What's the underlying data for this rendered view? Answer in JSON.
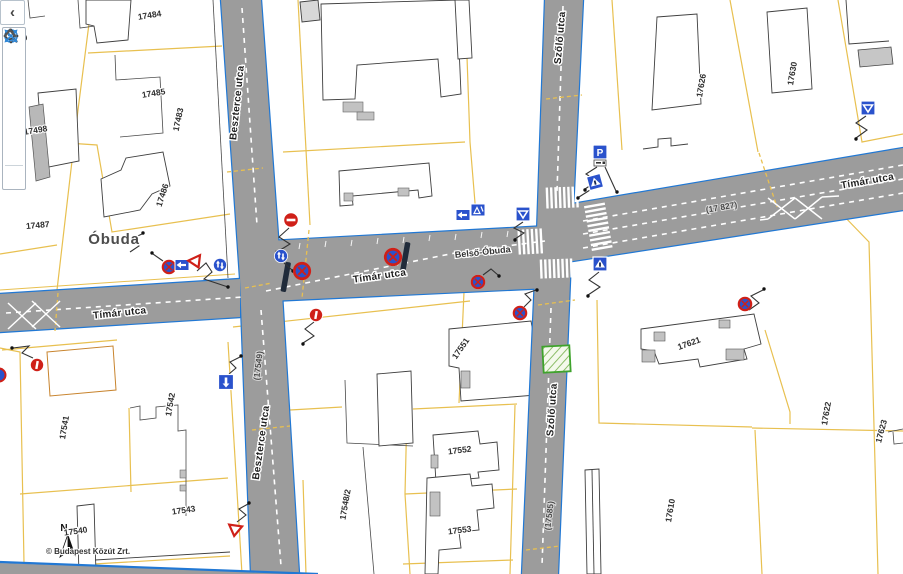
{
  "toolbar": {
    "collapse_glyph": "‹",
    "items": [
      "globe-icon",
      "globe-pan-icon",
      "zoom-in-icon",
      "zoom-out-icon",
      "zoom-previous-icon",
      "zoom-next-icon",
      "full-extent-icon"
    ],
    "more_tools_indicator": "scroll-up-icon"
  },
  "map": {
    "copyright": "© Budapest Közút Zrt.",
    "north_label": "N",
    "colors": {
      "road_fill": "#9c9c9c",
      "road_edge": "#2178d4",
      "parcel_line": "#e8c050",
      "sign_blue": "#2a52cc",
      "sign_red": "#cf2018",
      "green_zone": "#3fa32c"
    },
    "street_labels": [
      {
        "text": "Tímár utca",
        "x": 120,
        "y": 316,
        "rot": -6,
        "kind": "street"
      },
      {
        "text": "Tímár utca",
        "x": 380,
        "y": 279,
        "rot": -8,
        "kind": "street"
      },
      {
        "text": "Tímár utca",
        "x": 868,
        "y": 184,
        "rot": -10,
        "kind": "street"
      },
      {
        "text": "Szőlő utca",
        "x": 563,
        "y": 38,
        "rot": -85,
        "kind": "street"
      },
      {
        "text": "Szőlő utca",
        "x": 555,
        "y": 410,
        "rot": -86,
        "kind": "street"
      },
      {
        "text": "Beszterce utca",
        "x": 240,
        "y": 103,
        "rot": -84,
        "kind": "street"
      },
      {
        "text": "Beszterce utca",
        "x": 264,
        "y": 443,
        "rot": -82,
        "kind": "street"
      },
      {
        "text": "Belső-Óbuda",
        "x": 483,
        "y": 255,
        "rot": -6,
        "kind": "sub"
      },
      {
        "text": "Óbuda",
        "x": 114,
        "y": 244,
        "rot": 0,
        "kind": "district"
      }
    ],
    "parcel_labels": [
      {
        "text": "17484",
        "x": 150,
        "y": 18,
        "rot": -9
      },
      {
        "text": "17485",
        "x": 154,
        "y": 96,
        "rot": -9
      },
      {
        "text": "17498",
        "x": 36,
        "y": 133,
        "rot": -9
      },
      {
        "text": "17499",
        "x": 16,
        "y": 42,
        "rot": -9
      },
      {
        "text": "17483",
        "x": 181,
        "y": 120,
        "rot": -78
      },
      {
        "text": "17486",
        "x": 165,
        "y": 196,
        "rot": -72
      },
      {
        "text": "17487",
        "x": 38,
        "y": 228,
        "rot": -5
      },
      {
        "text": "17540",
        "x": 76,
        "y": 534,
        "rot": -8
      },
      {
        "text": "17541",
        "x": 67,
        "y": 428,
        "rot": -80
      },
      {
        "text": "17542",
        "x": 173,
        "y": 405,
        "rot": -80
      },
      {
        "text": "17543",
        "x": 184,
        "y": 513,
        "rot": -8
      },
      {
        "text": "17548/2",
        "x": 348,
        "y": 505,
        "rot": -80
      },
      {
        "text": "17551",
        "x": 463,
        "y": 350,
        "rot": -55
      },
      {
        "text": "17552",
        "x": 460,
        "y": 453,
        "rot": -7
      },
      {
        "text": "17553",
        "x": 460,
        "y": 533,
        "rot": -7
      },
      {
        "text": "17610",
        "x": 673,
        "y": 511,
        "rot": -80
      },
      {
        "text": "17621",
        "x": 690,
        "y": 346,
        "rot": -20
      },
      {
        "text": "17622",
        "x": 829,
        "y": 414,
        "rot": -80
      },
      {
        "text": "17623",
        "x": 884,
        "y": 432,
        "rot": -75
      },
      {
        "text": "17626",
        "x": 704,
        "y": 86,
        "rot": -80
      },
      {
        "text": "17630",
        "x": 795,
        "y": 74,
        "rot": -80
      }
    ],
    "road_ref_labels": [
      {
        "text": "(17 827)",
        "x": 722,
        "y": 210,
        "rot": -10
      },
      {
        "text": "(17585)",
        "x": 552,
        "y": 516,
        "rot": -83
      },
      {
        "text": "(17549)",
        "x": 261,
        "y": 366,
        "rot": -83
      }
    ],
    "signs": [
      {
        "type": "no-entry-sign",
        "x": 291,
        "y": 220
      },
      {
        "type": "no-stopping-sign",
        "x": 302,
        "y": 271,
        "s": 1.25
      },
      {
        "type": "no-stopping-sign",
        "x": 393,
        "y": 257,
        "s": 1.25
      },
      {
        "type": "no-stopping-sign",
        "x": 478,
        "y": 282,
        "s": 1
      },
      {
        "type": "no-stopping-sign",
        "x": 520,
        "y": 313,
        "s": 1
      },
      {
        "type": "no-stopping-sign",
        "x": 169,
        "y": 267,
        "s": 1
      },
      {
        "type": "no-stopping-sign",
        "x": 745,
        "y": 304,
        "s": 1
      },
      {
        "type": "no-parking-sign",
        "x": 316,
        "y": 315
      },
      {
        "type": "no-parking-sign",
        "x": 37,
        "y": 365
      },
      {
        "type": "arrow-left-sign",
        "x": 182,
        "y": 265
      },
      {
        "type": "arrow-left-sign",
        "x": 463,
        "y": 215
      },
      {
        "type": "lane-direction-sign",
        "x": 478,
        "y": 210
      },
      {
        "type": "yield-sign",
        "x": 196,
        "y": 262,
        "rot": -25
      },
      {
        "type": "yield-sign",
        "x": 235,
        "y": 530,
        "rot": 8
      },
      {
        "type": "keep-right-sign",
        "x": 220,
        "y": 265
      },
      {
        "type": "keep-right-sign",
        "x": 281,
        "y": 256
      },
      {
        "type": "parking-sign",
        "x": 600,
        "y": 152,
        "label": "P"
      },
      {
        "type": "ped-crossing-sign",
        "x": 595,
        "y": 182,
        "rot": -15
      },
      {
        "type": "ped-crossing-sign",
        "x": 600,
        "y": 264
      },
      {
        "type": "give-way-ahead-sign",
        "x": 523,
        "y": 214
      },
      {
        "type": "give-way-ahead-sign",
        "x": 868,
        "y": 108
      },
      {
        "type": "one-way-down-sign",
        "x": 226,
        "y": 382
      },
      {
        "type": "half-circle-sign",
        "x": -1,
        "y": 375
      }
    ]
  }
}
